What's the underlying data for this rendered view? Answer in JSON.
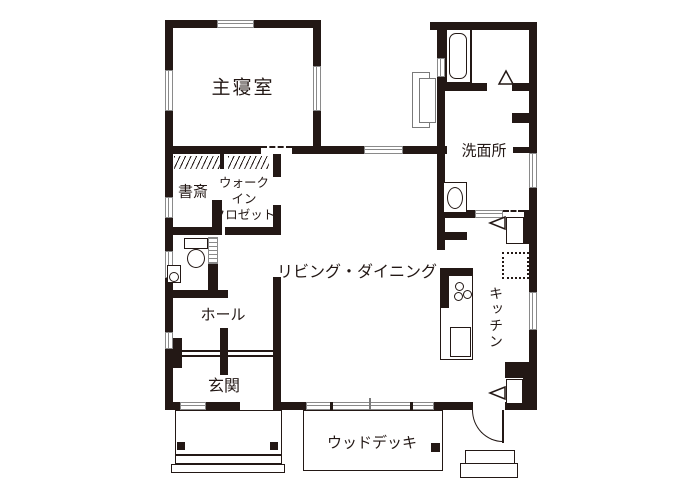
{
  "plan_type": "japanese-residential-floor-plan",
  "colors": {
    "wall": "#231815",
    "background": "#ffffff",
    "fixture_line": "#595757",
    "window_frame": "#8a8a8a"
  },
  "rooms": {
    "bedroom": "主寝室",
    "study": "書斎",
    "walk_in_closet": "ウォーク\nイン\nクロゼット",
    "washroom": "洗面所",
    "living_dining": "リビング・ダイニング",
    "kitchen": "キッチン",
    "hall": "ホール",
    "entrance": "玄関",
    "wood_deck": "ウッドデッキ"
  },
  "fixtures": [
    "bathtub",
    "washbasin",
    "toilet",
    "toilet-hand-sink",
    "kitchen-counter",
    "stove-burners",
    "kitchen-sink",
    "refrigerator-space",
    "storage-cabinet",
    "water-heater-unit",
    "closet-hanger-rods",
    "entrance-porch-steps",
    "wood-deck",
    "back-door-steps",
    "door-swing-arcs"
  ]
}
